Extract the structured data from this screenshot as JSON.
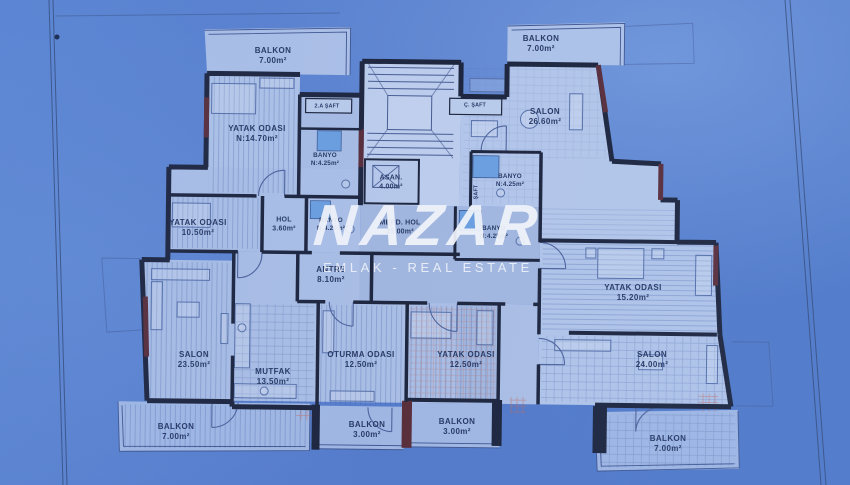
{
  "watermark": {
    "brand": "NAZAR",
    "tagline": "EMLAK - REAL ESTATE"
  },
  "rooms": {
    "balkon_top_left": {
      "name": "BALKON",
      "area": "7.00m²"
    },
    "yatak_odasi_n1470": {
      "name": "YATAK ODASI",
      "area": "N:14.70m²"
    },
    "banyo_top_left": {
      "name": "BANYO",
      "area": "N:4.25m²"
    },
    "balkon_top_right": {
      "name": "BALKON",
      "area": "7.00m²"
    },
    "salon_2660": {
      "name": "SALON",
      "area": "26.60m²"
    },
    "banyo_top_right": {
      "name": "BANYO",
      "area": "N:4.25m²"
    },
    "asansor": {
      "name": "ASAN.",
      "area": "4.00m²"
    },
    "yatak_odasi_1050": {
      "name": "YATAK ODASI",
      "area": "10.50m²"
    },
    "hol": {
      "name": "HOL",
      "area": "3.60m²"
    },
    "banyo_middle": {
      "name": "BANYO",
      "area": "N:4.20m²"
    },
    "merdiven_hol": {
      "name": "MERD. HOL",
      "area": "25.00m²"
    },
    "banyo_right": {
      "name": "BANYO",
      "area": "N:4.25m²"
    },
    "antre": {
      "name": "ANTRE",
      "area": "8.10m²"
    },
    "yatak_odasi_1520": {
      "name": "YATAK ODASI",
      "area": "15.20m²"
    },
    "salon_2350": {
      "name": "SALON",
      "area": "23.50m²"
    },
    "mutfak": {
      "name": "MUTFAK",
      "area": "13.50m²"
    },
    "oturma_odasi": {
      "name": "OTURMA ODASI",
      "area": "12.50m²"
    },
    "yatak_odasi_1250": {
      "name": "YATAK ODASI",
      "area": "12.50m²"
    },
    "salon_2400": {
      "name": "SALON",
      "area": "24.00m²"
    },
    "balkon_bottom_left": {
      "name": "BALKON",
      "area": "7.00m²"
    },
    "balkon_bottom_mid_1": {
      "name": "BALKON",
      "area": "3.00m²"
    },
    "balkon_bottom_mid_2": {
      "name": "BALKON",
      "area": "3.00m²"
    },
    "balkon_bottom_right": {
      "name": "BALKON",
      "area": "7.00m²"
    }
  },
  "shafts": {
    "left": "2.A ŞAFT",
    "right": "Ç. ŞAFT",
    "vertical": "ŞAFT"
  },
  "colors": {
    "photo_blue": "#5b84cf",
    "wall": "#1b2135",
    "accent_maroon": "#5c2a31",
    "room_fill": "#b4c7e9",
    "fixture_blue": "#6ea3e2",
    "watermark_white": "#ffffff"
  }
}
